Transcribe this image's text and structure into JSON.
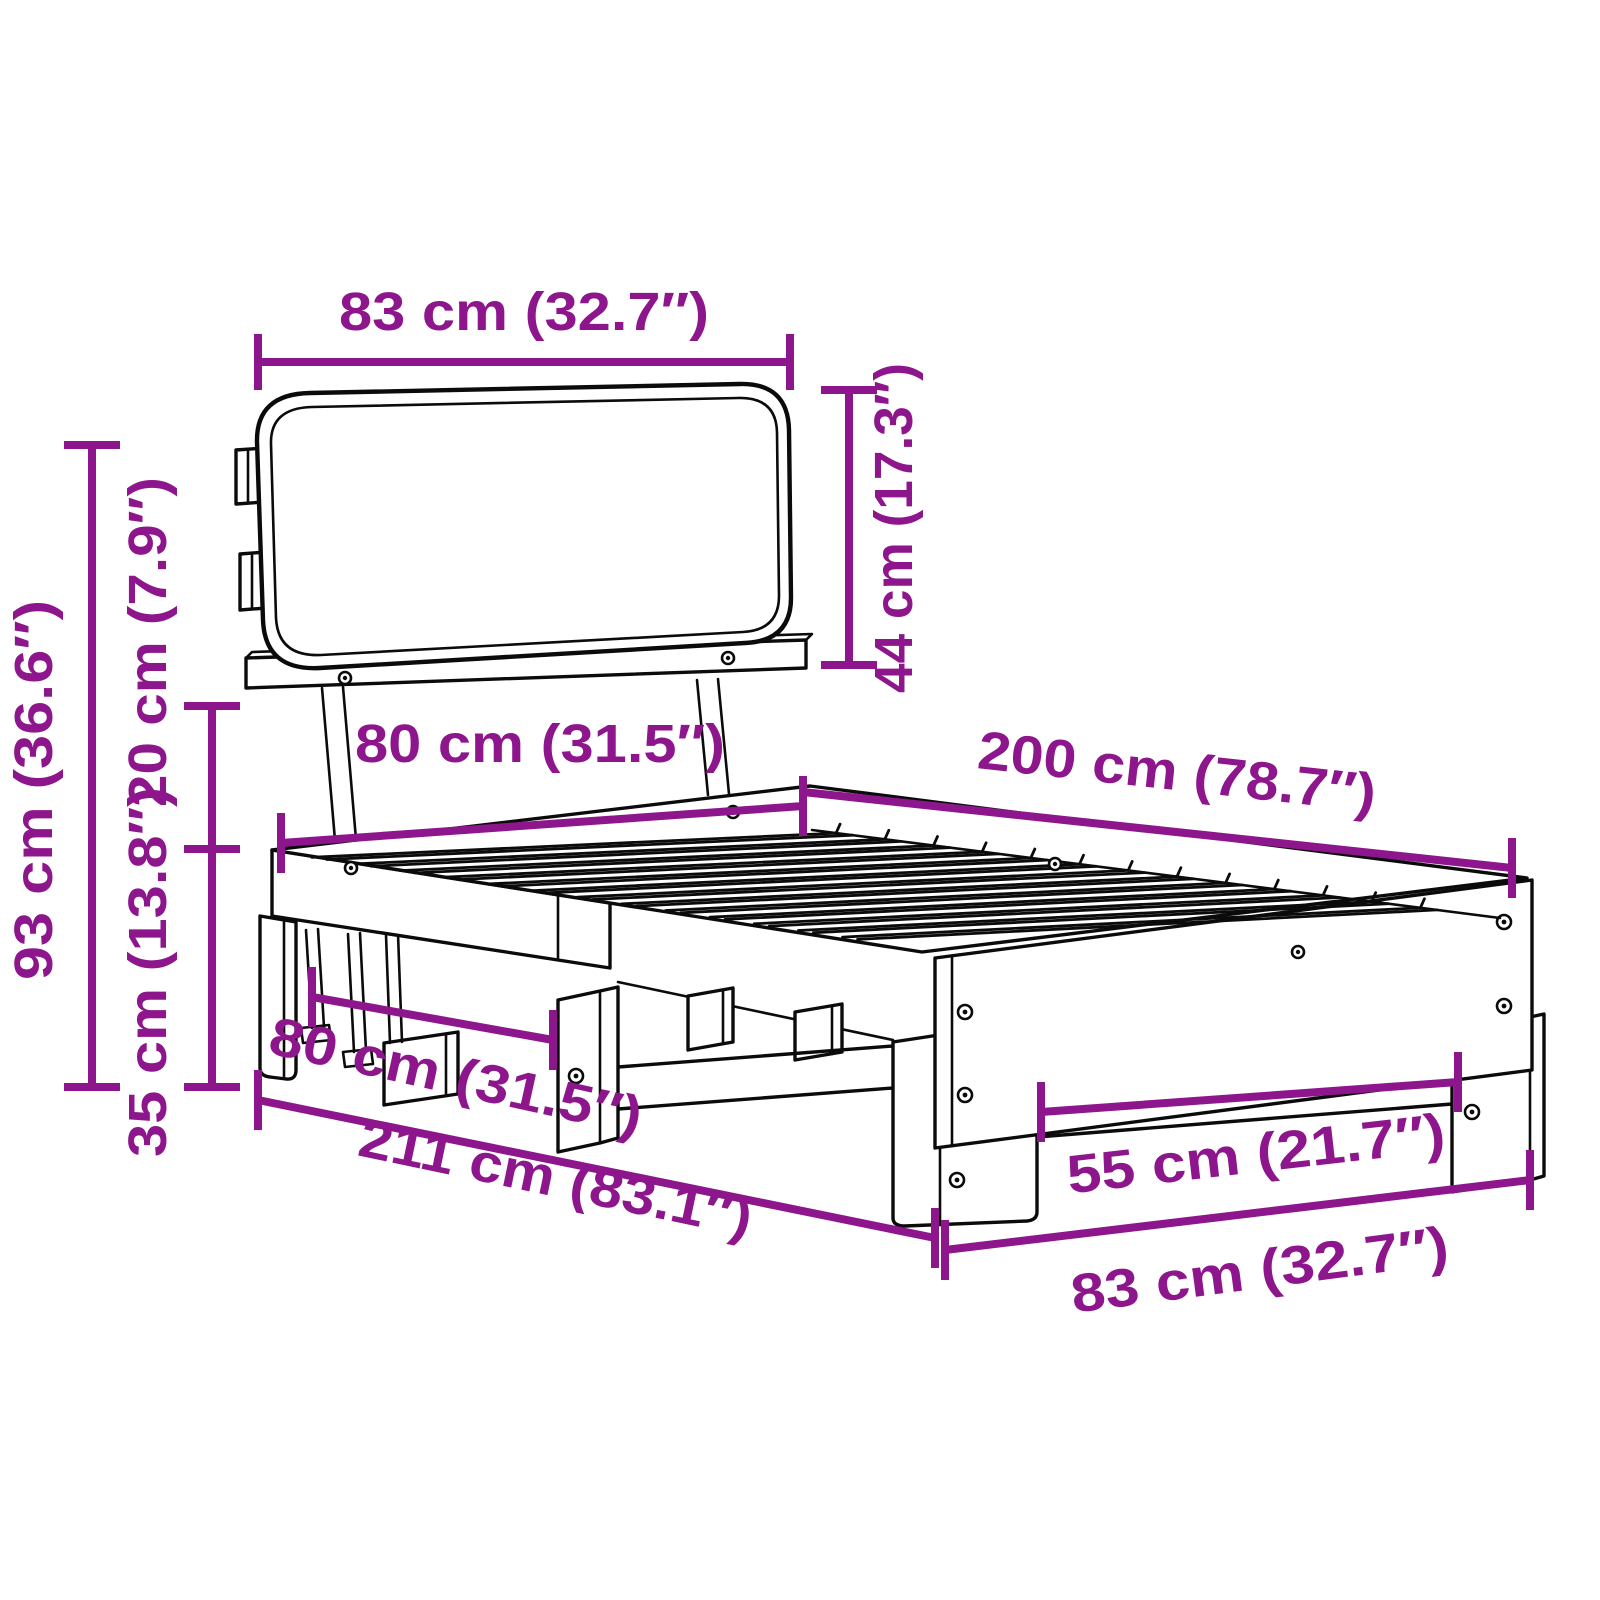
{
  "canvas": {
    "background": "#ffffff",
    "line_color": "#0b0b0b",
    "dimension_color": "#8E168C"
  },
  "diagram": {
    "type": "product-dimension-diagram",
    "subject": "Bed frame with headboard cushion, pallet base and slatted top - dimension drawing",
    "slat_count": 13,
    "dimensions": [
      {
        "id": "headboard-width",
        "label": "83 cm (32.7″)"
      },
      {
        "id": "headboard-height",
        "label": "44 cm (17.3″)"
      },
      {
        "id": "total-height",
        "label": "93 cm (36.6″)"
      },
      {
        "id": "headboard-gap",
        "label": "20 cm (7.9″)"
      },
      {
        "id": "frame-height",
        "label": "35 cm (13.8″)"
      },
      {
        "id": "bed-width-top",
        "label": "80 cm (31.5″)"
      },
      {
        "id": "bed-length-top",
        "label": "200 cm (78.7″)"
      },
      {
        "id": "base-width",
        "label": "80 cm (31.5″)"
      },
      {
        "id": "total-length",
        "label": "211 cm (83.1″)"
      },
      {
        "id": "leg-spacing",
        "label": "55 cm (21.7″)"
      },
      {
        "id": "foot-width",
        "label": "83 cm (32.7″)"
      }
    ]
  }
}
